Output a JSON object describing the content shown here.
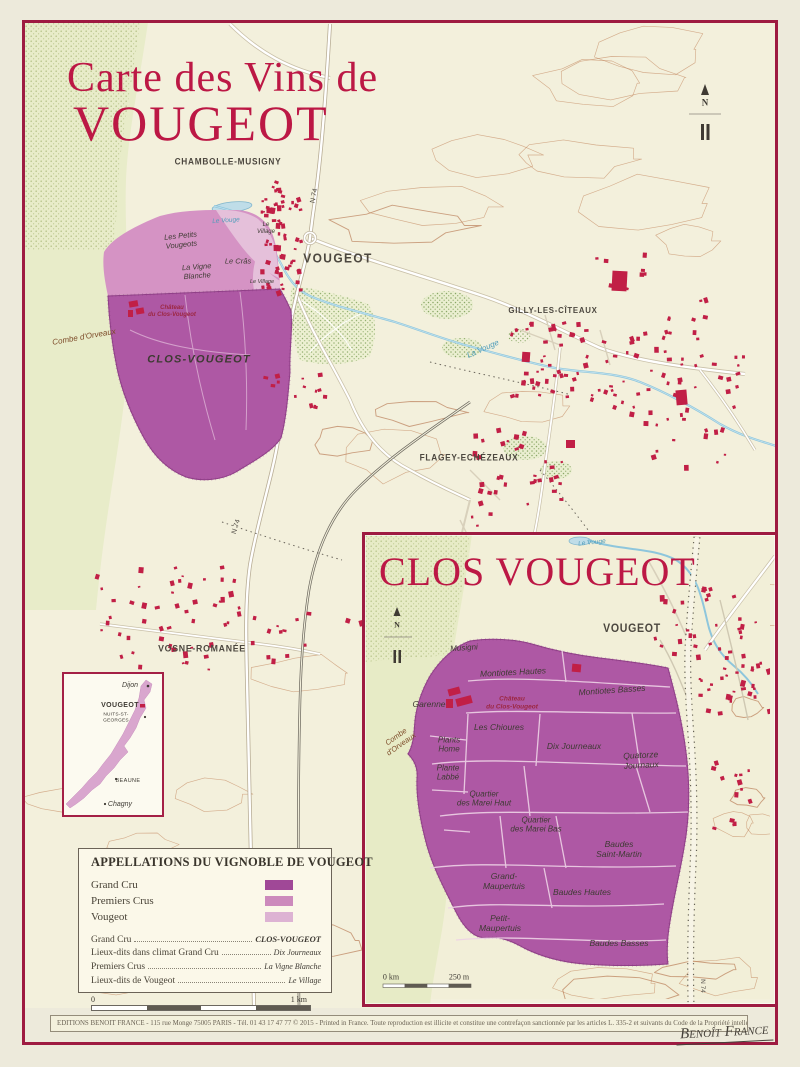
{
  "poster": {
    "title_line1": "Carte des Vins de",
    "title_line2": "VOUGEOT"
  },
  "main_map": {
    "towns": {
      "chambolle": "CHAMBOLLE-MUSIGNY",
      "vougeot": "VOUGEOT",
      "gilly": "GILLY-LES-CÎTEAUX",
      "flagey": "FLAGEY-ECHÉZEAUX",
      "vosne": "VOSNE-ROMANÉE"
    },
    "vineyards": {
      "clos_vougeot": "CLOS-VOUGEOT",
      "petits_vougeots": "Les Petits\nVougeots",
      "vigne_blanche": "La Vigne\nBlanche",
      "le_cras": "Le Crâs",
      "le_village_nord": "Le\nVillage",
      "le_village_sud": "Le Village",
      "chateau": "Château\ndu Clos-Vougeot"
    },
    "rivers": {
      "le_vouge": "Le Vouge",
      "la_vouge": "La Vouge"
    },
    "roads": {
      "n74": "N 74"
    },
    "terrain": {
      "combe": "Combe d'Orveaux"
    },
    "north": "N"
  },
  "inset_map": {
    "title": "CLOS VOUGEOT",
    "town": "VOUGEOT",
    "river": "Le Vouge",
    "road": "N 74",
    "terrain": "Combe\nd'Orveaux",
    "north": "N",
    "chateau": "Château\ndu Clos-Vougeot",
    "lieux_dits": {
      "musigni": "Musigni",
      "montiotes_hautes": "Montiotes Hautes",
      "montiotes_basses": "Montiotes Basses",
      "garenne": "Garenne",
      "les_chioures": "Les Chioures",
      "dix_journeaux": "Dix Journeaux",
      "quatorze_journaux": "Quatorze\nJournaux",
      "plants_home": "Plants\nHome",
      "plante_labbe": "Plante\nLabbé",
      "marei_haut": "Quartier\ndes Marei Haut",
      "marei_bas": "Quartier\ndes Marei Bas",
      "baudes_saint_martin": "Baudes\nSaint-Martin",
      "grand_maupertuis": "Grand-\nMaupertuis",
      "baudes_hautes": "Baudes Hautes",
      "petit_maupertuis": "Petit-\nMaupertuis",
      "baudes_basses": "Baudes Basses"
    },
    "scale": {
      "left": "0 km",
      "right": "250 m"
    }
  },
  "locator": {
    "dijon": "Dijon",
    "vougeot": "VOUGEOT",
    "nuits": "NUITS-ST-GEORGES",
    "beaune": "BEAUNE",
    "chagny": "Chagny"
  },
  "legend": {
    "title": "APPELLATIONS DU VIGNOBLE DE VOUGEOT",
    "swatches": [
      {
        "label": "Grand Cru",
        "color": "#a04897"
      },
      {
        "label": "Premiers Crus",
        "color": "#cc8abc"
      },
      {
        "label": "Vougeot",
        "color": "#ddb3d3"
      }
    ],
    "entries": [
      {
        "label": "Grand Cru",
        "value": "CLOS-VOUGEOT"
      },
      {
        "label": "Lieux-dits dans climat Grand Cru",
        "value": "Dix Journeaux"
      },
      {
        "label": "Premiers Crus",
        "value": "La Vigne Blanche"
      },
      {
        "label": "Lieux-dits de Vougeot",
        "value": "Le Village"
      }
    ],
    "scale": {
      "left": "0",
      "right": "1 km"
    }
  },
  "footer": {
    "text": "EDITIONS BENOIT FRANCE - 115 rue Monge 75005 PARIS - Tél. 01 43 17 47 77 © 2015 - Printed in France. Toute reproduction est illicite et constitue une contrefaçon sanctionnée par les articles L. 335-2 et suivants du Code de la Propriété intellectuelle.",
    "signature": "Benoît France"
  },
  "colors": {
    "grand_cru": "#ae58a4",
    "premiers_crus": "#d593c4",
    "vougeot_appellation": "#e5c0da",
    "frame_border": "#9e1b41",
    "title_red": "#bc1845",
    "building_red": "#c11f46",
    "map_background": "#f3f0dc"
  }
}
